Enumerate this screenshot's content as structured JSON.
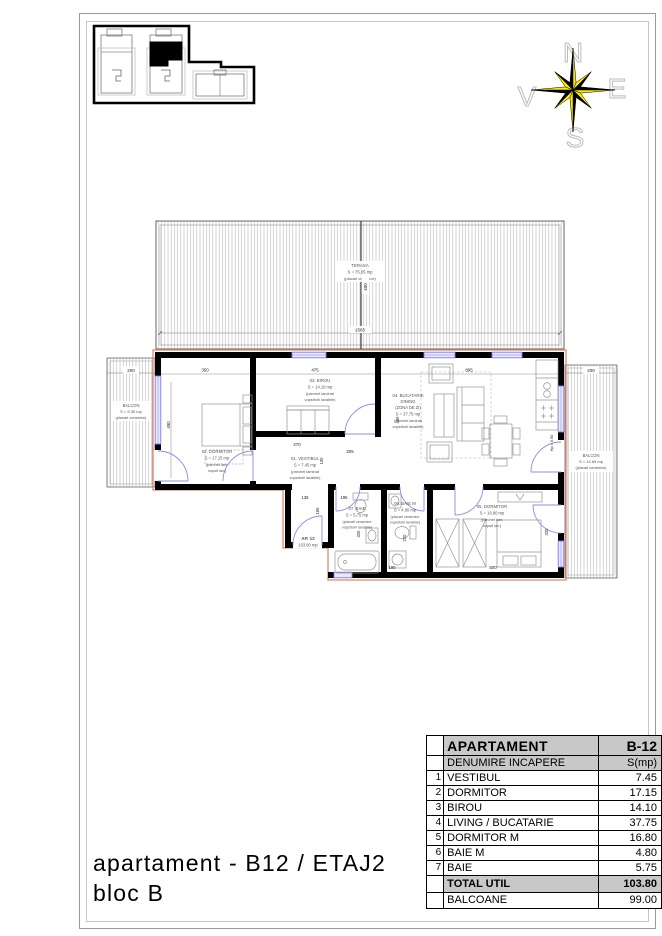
{
  "page": {
    "title_line1": "apartament - B12 / ETAJ2",
    "title_line2": "bloc B"
  },
  "compass": {
    "north": "N",
    "east": "E",
    "south": "S",
    "west": "V"
  },
  "colors": {
    "wall": "#000000",
    "openings_blue": "#8b8bf0",
    "apartment_outline": "#e2886a",
    "compass_yellow": "#ffe800",
    "table_header_bg": "#c8c8c8"
  },
  "table": {
    "header": {
      "label": "APARTAMENT",
      "value": "B-12"
    },
    "subheader": {
      "label": "DENUMIRE INCAPERE",
      "value": "S(mp)"
    },
    "rows": [
      {
        "num": "1",
        "label": "VESTIBUL",
        "value": "7.45"
      },
      {
        "num": "2",
        "label": "DORMITOR",
        "value": "17.15"
      },
      {
        "num": "3",
        "label": "BIROU",
        "value": "14.10"
      },
      {
        "num": "4",
        "label": "LIVING / BUCATARIE",
        "value": "37.75"
      },
      {
        "num": "5",
        "label": "DORMITOR M",
        "value": "16.80"
      },
      {
        "num": "6",
        "label": "BAIE M",
        "value": "4.80"
      },
      {
        "num": "7",
        "label": "BAIE",
        "value": "5.75"
      }
    ],
    "total": {
      "label": "TOTAL UTIL",
      "value": "103.80"
    },
    "balconies": {
      "label": "BALCOANE",
      "value": "99.00"
    }
  },
  "plan": {
    "terasa": {
      "name": "TERASA",
      "area": "S = 75.05 mp",
      "f1": "(placari ceramice)"
    },
    "balcon_left": {
      "name": "BALCON",
      "area": "S = 9.30 mp",
      "f1": "(placari ceramice)"
    },
    "balcon_right": {
      "name": "BALCON",
      "area": "S = 14.65 mp",
      "f1": "(placari ceramice)"
    },
    "vestibul": {
      "name": "01. VESTIBUL",
      "area": "S = 7.45 mp",
      "f1": "(parchet laminat",
      "f2": "vopsitorii lavabile)"
    },
    "dormitor": {
      "name": "02. DORMITOR",
      "area": "S = 17.15 mp",
      "f1": "(parchet lam.",
      "f2": "vopsit lav.)"
    },
    "birou": {
      "name": "03. BIROU",
      "area": "S = 14.10 mp",
      "f1": "(parchet laminat",
      "f2": "vopsitorii lavabile)"
    },
    "living": {
      "name": "04. BUCATARIE",
      "l2": "DINING",
      "l3": "(ZONA DE ZI)",
      "area": "S = 37.75 mp",
      "f1": "(parchet laminat",
      "f2": "vopsitorii lavabile)"
    },
    "dormitor_m": {
      "name": "05. DORMITOR",
      "area": "S = 16.80 mp",
      "f1": "(parchet lam.",
      "f2": "vopsit lav.)"
    },
    "baie_m": {
      "name": "06. BAIE M",
      "area": "S = 4.80 mp",
      "f1": "(placari ceramice",
      "f2": "vopsitorii lavabile)"
    },
    "baie": {
      "name": "07. BAIE",
      "area": "S = 5.75 mp",
      "f1": "(placari ceramice",
      "f2": "vopsitorii lavabile)"
    },
    "ap_label": {
      "l1": "AP. 12",
      "l2": "103.80 mp"
    },
    "dims": {
      "bal_left_w": "200",
      "dorm_w": "350",
      "birou_w": "475",
      "living_w": "895",
      "bal_right_w": "200",
      "terasa_w": "1565",
      "terasa_h": "400",
      "dorm_h": "490",
      "vest_w": "270",
      "hall_open": "205",
      "hall_h": "100",
      "entry_w": "135",
      "entry_h": "165",
      "baie_w": "195",
      "baie_h": "320",
      "baiem_w": "190",
      "baiem_h": "220",
      "dormm_w": "500",
      "dormm_h": "320",
      "kitchen_h": "490",
      "parapet": "Hp = 0.90"
    }
  }
}
